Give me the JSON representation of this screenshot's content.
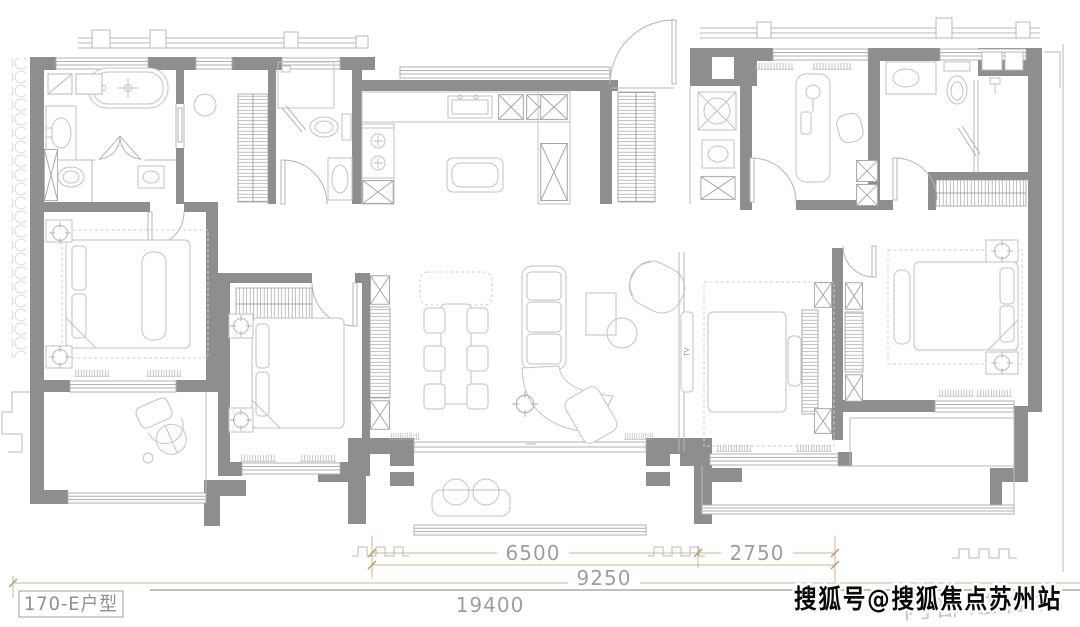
{
  "unit": {
    "label": "170-E户型"
  },
  "dimensions": {
    "segment_left": "6500",
    "segment_right": "2750",
    "subtotal": "9250",
    "total": "19400"
  },
  "tv": {
    "label": "TV"
  },
  "watermark": {
    "publisher": "搜狐号@搜狐焦点苏州站",
    "draft": "内部过程稿"
  },
  "colors": {
    "background": "#ffffff",
    "wall": "#8e8e8e",
    "line": "#b9b9b9",
    "furniture": "#c2c2c2",
    "dimension_line": "#cdb492",
    "dimension_text": "#9e9e9e",
    "label_text": "#8f8f8f",
    "watermark_fill": "#0a0a0a",
    "watermark_outline": "#ffffff",
    "draft_text": "#c9c9c9"
  }
}
